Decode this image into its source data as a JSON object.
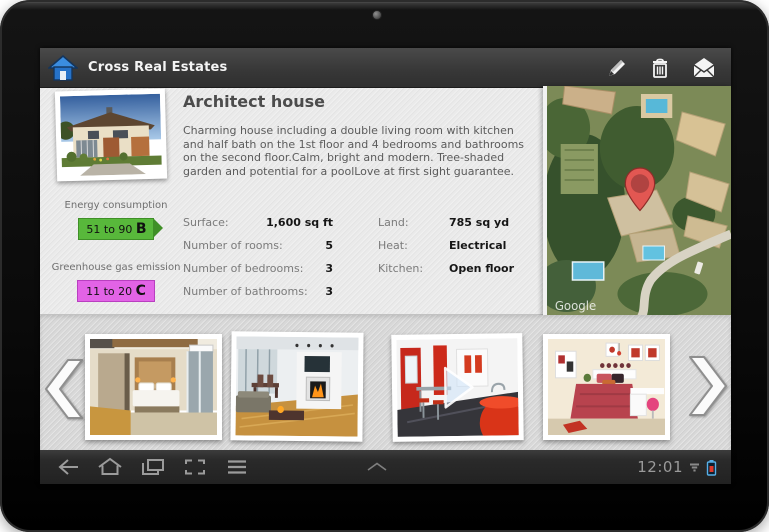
{
  "app_bar": {
    "title": "Cross Real Estates",
    "icons": [
      "home-icon",
      "edit-icon",
      "trash-icon",
      "mail-icon"
    ]
  },
  "property": {
    "title": "Architect house",
    "description": "Charming house including a double living room with kitchen and half bath on the 1st floor and 4 bedrooms and bathrooms on the second floor.Calm, bright and modern. Tree-shaded garden and potential for a poolLove at first sight guarantee.",
    "price": "$480,000",
    "photo": "house-exterior-photo"
  },
  "energy": {
    "consumption_label": "Energy consumption",
    "consumption_range": "51 to 90 ",
    "consumption_grade": "B",
    "consumption_color": "#58b83b",
    "emission_label": "Greenhouse gas emission",
    "emission_range": "11 to 20 ",
    "emission_grade": "C",
    "emission_color": "#e263e6"
  },
  "details": {
    "left": [
      {
        "label": "Surface:",
        "value": "1,600 sq ft"
      },
      {
        "label": "Number of rooms:",
        "value": "5"
      },
      {
        "label": "Number of bedrooms:",
        "value": "3"
      },
      {
        "label": "Number of bathrooms:",
        "value": "3"
      }
    ],
    "right": [
      {
        "label": "Land:",
        "value": "785 sq yd"
      },
      {
        "label": "Heat:",
        "value": "Electrical"
      },
      {
        "label": "Kitchen:",
        "value": "Open floor"
      }
    ]
  },
  "map": {
    "watermark": "Google",
    "pin": "location-pin"
  },
  "carousel": {
    "photos": [
      "bedroom-modern",
      "living-room-fireplace",
      "kitchen-red",
      "bedroom-red"
    ],
    "overlay_on_photo_3": "play-button"
  },
  "nav_bar": {
    "time": "12:01",
    "icons": [
      "back-icon",
      "home-icon",
      "recents-icon",
      "capture-icon",
      "menu-icon",
      "expand-icon",
      "signal-icon",
      "battery-icon"
    ]
  },
  "colors": {
    "price": "#cc0000",
    "accent_blue": "#2f82d9",
    "energy_green": "#58b83b",
    "emission_magenta": "#e263e6"
  }
}
